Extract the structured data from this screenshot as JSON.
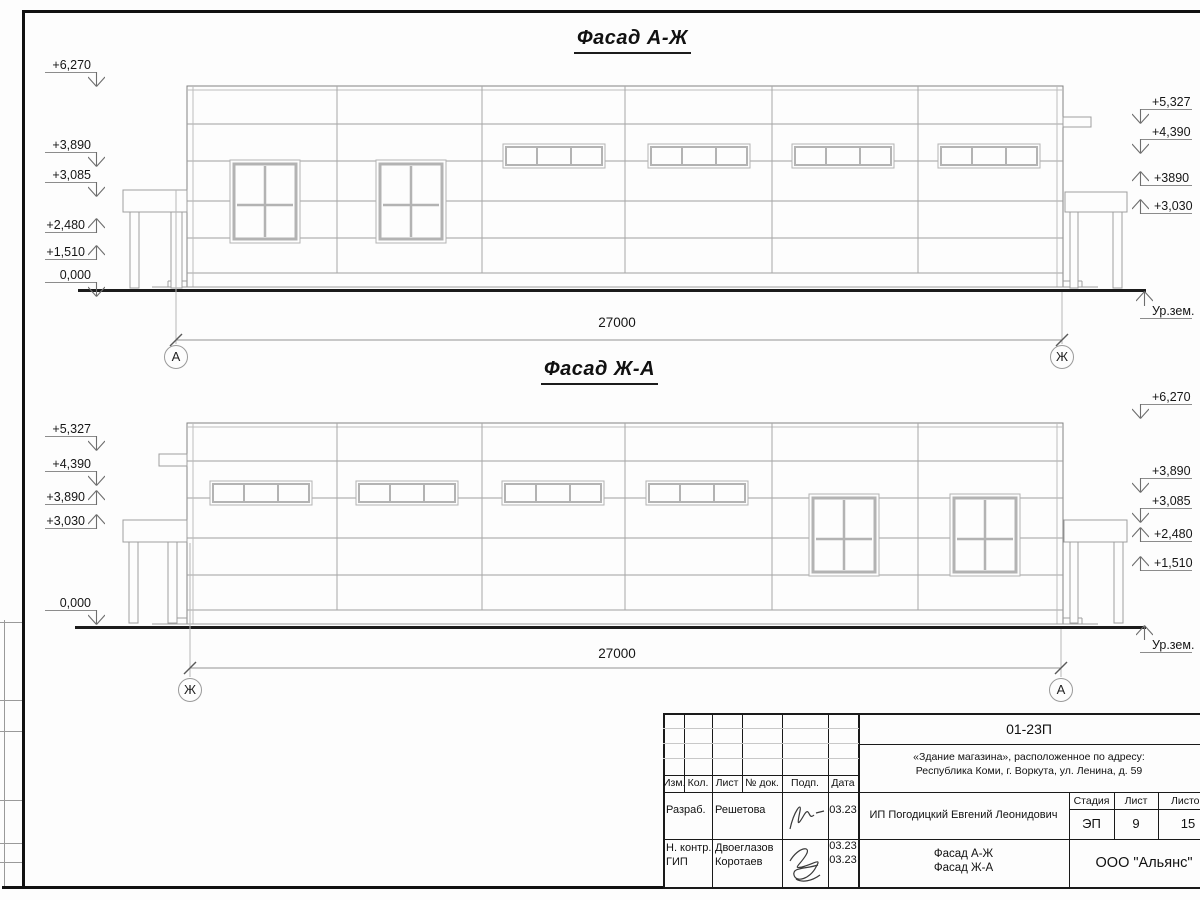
{
  "facade_top": {
    "title": "Фасад А-Ж",
    "dimension_label": "27000",
    "axis_left": "А",
    "axis_right": "Ж",
    "ground_level_label": "Ур.зем.",
    "marks_left": [
      {
        "label": "+6,270"
      },
      {
        "label": "+3,890"
      },
      {
        "label": "+3,085"
      },
      {
        "label": "+2,480"
      },
      {
        "label": "+1,510"
      },
      {
        "label": "0,000"
      }
    ],
    "marks_right": [
      {
        "label": "+5,327"
      },
      {
        "label": "+4,390"
      },
      {
        "label": "+3890"
      },
      {
        "label": "+3,030"
      }
    ]
  },
  "facade_bottom": {
    "title": "Фасад Ж-А",
    "dimension_label": "27000",
    "axis_left": "Ж",
    "axis_right": "А",
    "ground_level_label": "Ур.зем.",
    "marks_left": [
      {
        "label": "+5,327"
      },
      {
        "label": "+4,390"
      },
      {
        "label": "+3,890"
      },
      {
        "label": "+3,030"
      },
      {
        "label": "0,000"
      }
    ],
    "marks_right": [
      {
        "label": "+6,270"
      },
      {
        "label": "+3,890"
      },
      {
        "label": "+3,085"
      },
      {
        "label": "+2,480"
      },
      {
        "label": "+1,510"
      }
    ]
  },
  "title_block": {
    "doc_code": "01-23П",
    "project_line1": "«Здание магазина», расположенное по адресу:",
    "project_line2": "Республика Коми, г. Воркута, ул. Ленина, д. 59",
    "client": "ИП Погодицкий Евгений Леонидович",
    "drawing_title_line1": "Фасад А-Ж",
    "drawing_title_line2": "Фасад Ж-А",
    "organization": "ООО \"Альянс\"",
    "stage_header": "Стадия",
    "sheet_header": "Лист",
    "sheets_header": "Листов",
    "stage_value": "ЭП",
    "sheet_value": "9",
    "sheets_value": "15",
    "revision_headers": [
      "Изм.",
      "Кол.",
      "Лист",
      "№ док.",
      "Подп.",
      "Дата"
    ],
    "signers": [
      {
        "role": "Разраб.",
        "name": "Решетова",
        "date": "03.23"
      },
      {
        "role": "Н. контр.",
        "name": "Двоеглазов",
        "date": "03.23"
      },
      {
        "role": "ГИП",
        "name": "Коротаев",
        "date": "03.23"
      }
    ]
  }
}
